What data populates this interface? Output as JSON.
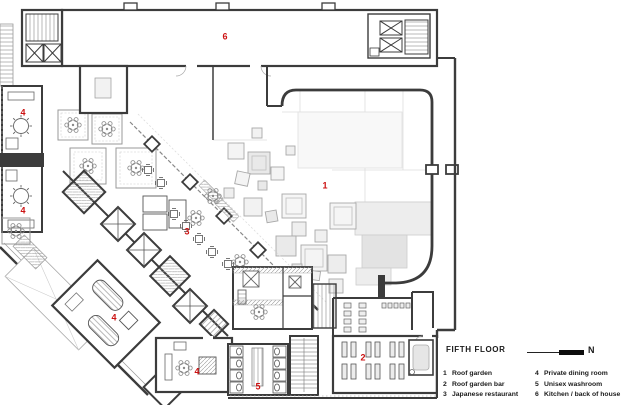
{
  "legend": {
    "title": "FIFTH FLOOR",
    "north_label": "N",
    "items_col1": [
      {
        "num": "1",
        "label": "Roof garden"
      },
      {
        "num": "2",
        "label": "Roof garden bar"
      },
      {
        "num": "3",
        "label": "Japanese restaurant"
      }
    ],
    "items_col2": [
      {
        "num": "4",
        "label": "Private dining room"
      },
      {
        "num": "5",
        "label": "Unisex washroom"
      },
      {
        "num": "6",
        "label": "Kitchen / back of house"
      }
    ]
  },
  "room_labels": [
    {
      "num": "6",
      "x": 225,
      "y": 37
    },
    {
      "num": "4",
      "x": 23,
      "y": 113
    },
    {
      "num": "4",
      "x": 23,
      "y": 211
    },
    {
      "num": "1",
      "x": 325,
      "y": 186
    },
    {
      "num": "3",
      "x": 187,
      "y": 232
    },
    {
      "num": "4",
      "x": 114,
      "y": 318
    },
    {
      "num": "4",
      "x": 197,
      "y": 372
    },
    {
      "num": "2",
      "x": 363,
      "y": 358
    },
    {
      "num": "5",
      "x": 258,
      "y": 387
    }
  ],
  "colors": {
    "room_label": "#cc1111",
    "wall": "#3c3c3c",
    "legend_text": "#1a1a1a"
  }
}
